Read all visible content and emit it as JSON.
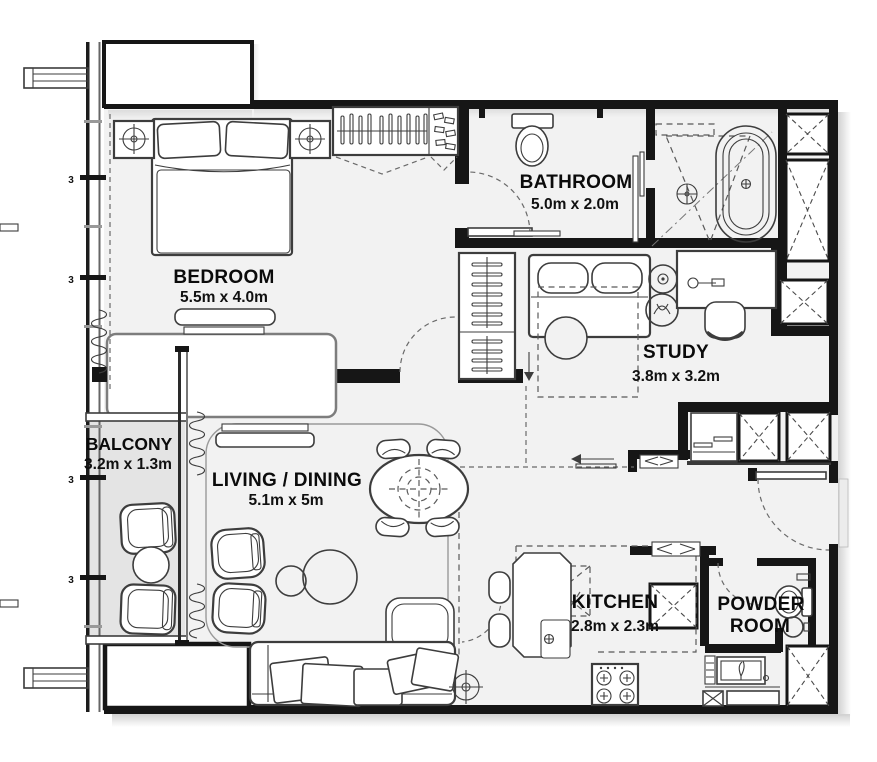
{
  "plan": {
    "colors": {
      "wall": "#161616",
      "interior_floor": "#f2f2f2",
      "balcony_floor": "#e4e4e4",
      "furniture_line": "#3d3d3d"
    },
    "rooms": {
      "bedroom": {
        "label": "BEDROOM",
        "dimensions": "5.5m x 4.0m"
      },
      "bathroom": {
        "label": "BATHROOM",
        "dimensions": "5.0m x 2.0m"
      },
      "study": {
        "label": "STUDY",
        "dimensions": "3.8m x 3.2m"
      },
      "balcony": {
        "label": "BALCONY",
        "dimensions": "3.2m x 1.3m"
      },
      "living_dining": {
        "label": "LIVING / DINING",
        "dimensions": "5.1m x 5m"
      },
      "kitchen": {
        "label": "KITCHEN",
        "dimensions": "2.8m x 2.3m"
      },
      "powder_room": {
        "label_line1": "POWDER",
        "label_line2": "ROOM"
      }
    },
    "markers": {
      "mullion_tag": "3"
    }
  }
}
